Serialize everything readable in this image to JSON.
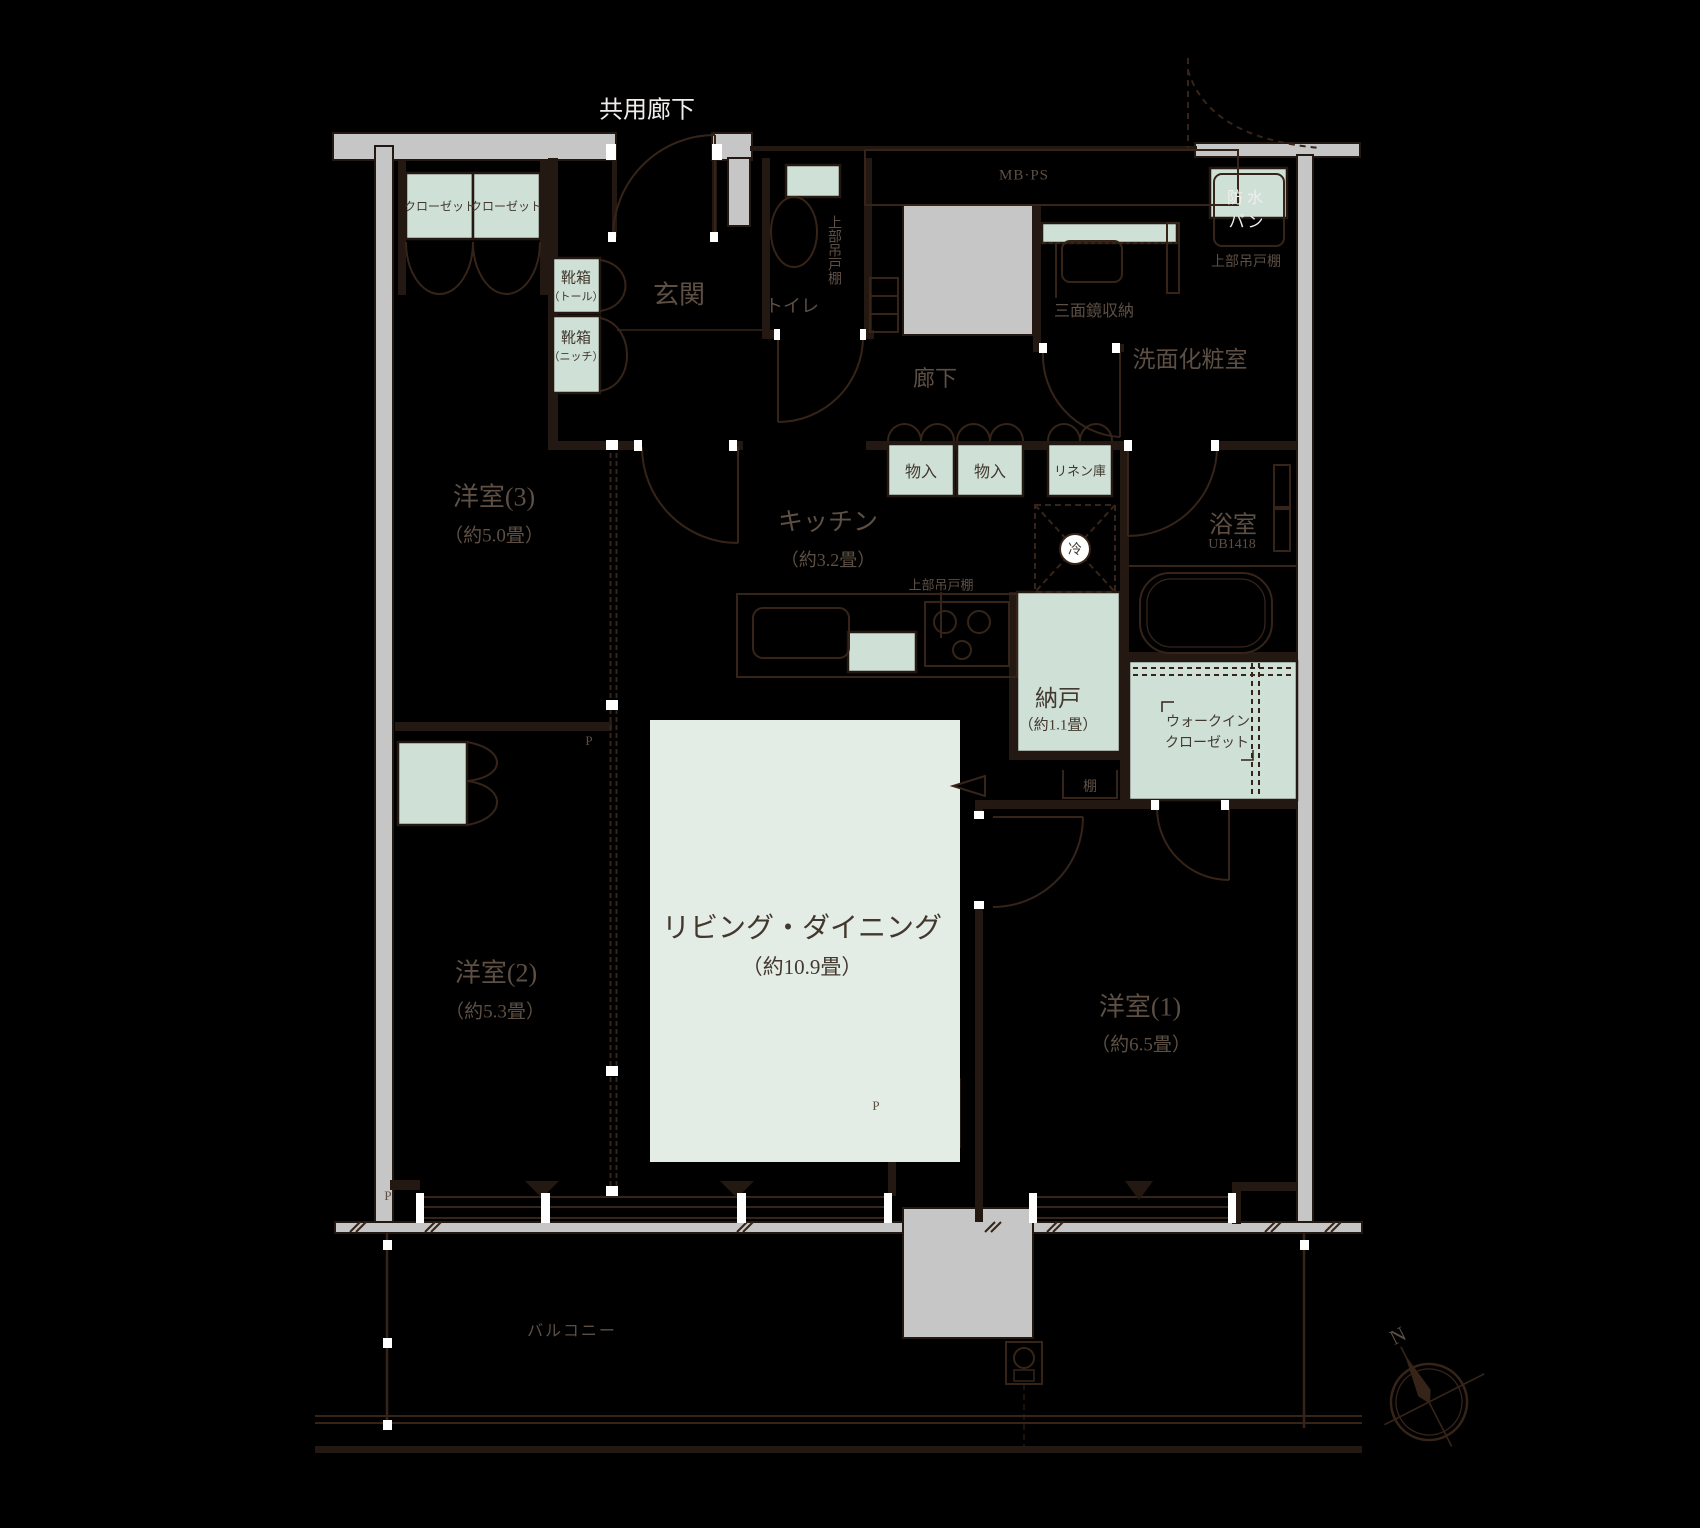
{
  "title": "マンション間取り図（3LDK＋納戸＋ウォークインクローゼット）",
  "colors": {
    "background": "#000000",
    "wall_gray": "#c6c6c6",
    "line_brown": "#362419",
    "storage_mint": "#cfe0d7",
    "living_mint": "#e4ece6",
    "label_dark": "#5d4f44",
    "label_white": "#f0eeec"
  },
  "labels": {
    "common_corridor": "共用廊下",
    "entrance": "玄関",
    "toilet": "トイレ",
    "upper_cabinet": "上部吊戸棚",
    "mbps": "MB·PS",
    "waterproof_line1": "防水",
    "waterproof_line2": "パン",
    "mirror_storage": "三面鏡収納",
    "washroom": "洗面化粧室",
    "corridor": "廊下",
    "closet": "クローゼット",
    "shoe_tall_line1": "靴箱",
    "shoe_tall_line2": "（トール）",
    "shoe_niche_line1": "靴箱",
    "shoe_niche_line2": "（ニッチ）",
    "storage_in1": "物入",
    "storage_in2": "物入",
    "linen": "リネン庫",
    "bath": "浴室",
    "bath_unit": "UB1418",
    "kitchen": "キッチン",
    "kitchen_size": "（約3.2畳）",
    "fridge": "冷",
    "storage_room": "納戸",
    "storage_room_size": "（約1.1畳）",
    "shelf": "棚",
    "wic_line1": "ウォークイン",
    "wic_line2": "クローゼット",
    "living": "リビング・ダイニング",
    "living_size": "（約10.9畳）",
    "west3": "洋室(3)",
    "west3_size": "（約5.0畳）",
    "west2": "洋室(2)",
    "west2_size": "（約5.3畳）",
    "west1": "洋室(1)",
    "west1_size": "（約6.5畳）",
    "balcony": "バルコニー",
    "pipe_space": "P",
    "north": "N"
  }
}
